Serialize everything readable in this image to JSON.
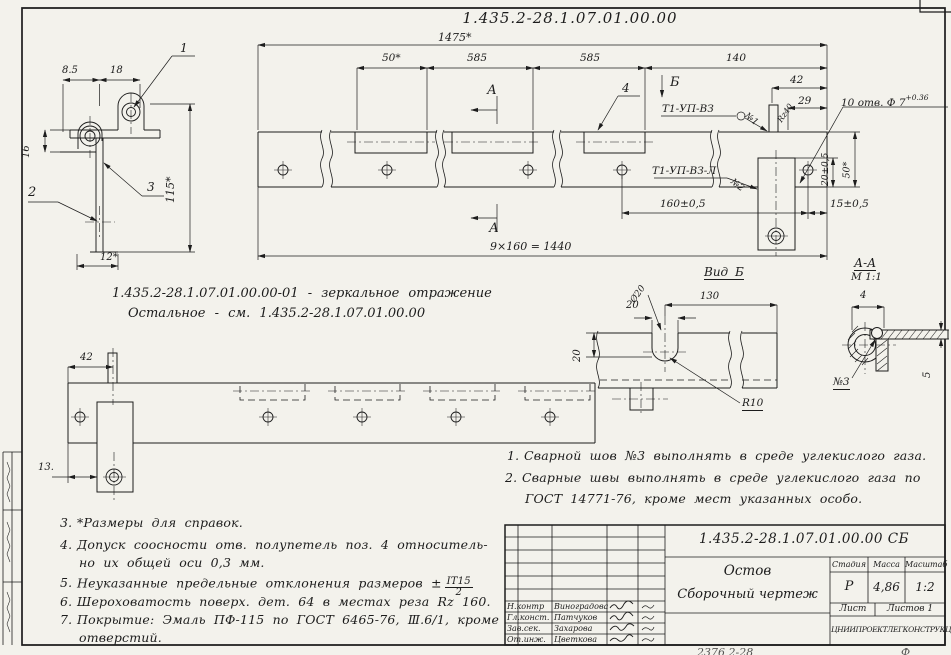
{
  "drawing": {
    "doc_number": "1.435.2-28.1.07.01.00.00",
    "mirror_note_line1": "1.435.2-28.1.07.01.00.00-01 -  зеркальное  отражение",
    "mirror_note_line2": "Остальное -  см.  1.435.2-28.1.07.01.00.00",
    "footer_cut_left": "2376 2-28",
    "footer_cut_right": "Ф"
  },
  "detail_view": {
    "dim_8_5": "8.5",
    "dim_18": "18",
    "dim_16": "16",
    "dim_115": "115*",
    "dim_12": "12*",
    "callout_1": "1",
    "callout_2": "2",
    "callout_3": "3"
  },
  "main_view": {
    "dim_1475": "1475*",
    "dim_50": "50*",
    "dim_585_1": "585",
    "dim_585_2": "585",
    "dim_140": "140",
    "dim_42": "42",
    "dim_29": "29",
    "holes_note": "10 отв. Ф 7",
    "holes_note_tol": "+0.36",
    "leader_roughness": "Rz40",
    "section_b": "Б",
    "section_a_top": "А",
    "section_a_bottom": "А",
    "callout_4": "4",
    "weld_label_1": "Т1-УП-ВЗ",
    "weld_no_1": "№1",
    "weld_label_2": "Т1-УП-ВЗ-Л",
    "weld_no_2": "№2",
    "dim_160": "160±0,5",
    "dim_15": "15±0,5",
    "dim_20v": "20±0,5",
    "dim_50v": "50*",
    "dim_row_total": "9×160 = 1440"
  },
  "bottom_view": {
    "dim_42": "42",
    "dim_13": "13."
  },
  "view_b": {
    "title": "Вид Б",
    "dim_20_slot": "20",
    "dim_130": "130",
    "dim_20_left": "20",
    "radius": "R10",
    "dia": "Ø20"
  },
  "section_aa": {
    "title": "А-А",
    "scale": "М 1:1",
    "dim_4": "4",
    "dim_5": "5",
    "weld_no": "№3"
  },
  "notes_right": {
    "n1": "1.",
    "t1": "Сварной  шов  №3  выполнять  в  среде  углекислого  газа.",
    "n2": "2.",
    "t2a": "Сварные  швы  выполнять  в  среде  углекислого  газа  по",
    "t2b": "ГОСТ 14771-76,  кроме  мест  указанных  особо."
  },
  "notes_left": {
    "n3": "3.",
    "t3": "*Размеры для справок.",
    "n4": "4.",
    "t4a": "Допуск  соосности  отв. полупетель  поз. 4 относитель-",
    "t4b": "но их общей  оси  0,3 мм.",
    "n5": "5.",
    "t5": "Неуказанные  предельные  отклонения  размеров ±",
    "t5_frac_num": "IT15",
    "t5_frac_den": "2",
    "n6": "6.",
    "t6": "Шероховатость  поверх.  дет. 64 в  местах  реза  Rz 160.",
    "n7": "7.",
    "t7a": "Покрытие:  Эмаль  ПФ-115  по  ГОСТ 6465-76, Ⅲ.6/1, кроме",
    "t7b": "отверстий."
  },
  "title_block": {
    "doc_number": "1.435.2-28.1.07.01.00.00 СБ",
    "name_line1": "Остов",
    "name_line2": "Сборочный  чертеж",
    "stage_header": "Стадия",
    "mass_header": "Масса",
    "scale_header": "Масштаб",
    "stage": "Р",
    "mass": "4,86",
    "scale": "1:2",
    "sheet": "Лист",
    "sheets": "Листов 1",
    "org": "ЦНИИПРОЕКТЛЕГКОНСТРУКЦИЯ",
    "sig_rows": [
      {
        "role": "Н.контр",
        "name": "Виноградова"
      },
      {
        "role": "Гл.конст.",
        "name": "Патчуков"
      },
      {
        "role": "Зав.сек.",
        "name": "Захарова"
      },
      {
        "role": "От.инж.",
        "name": "Цветкова"
      }
    ]
  }
}
